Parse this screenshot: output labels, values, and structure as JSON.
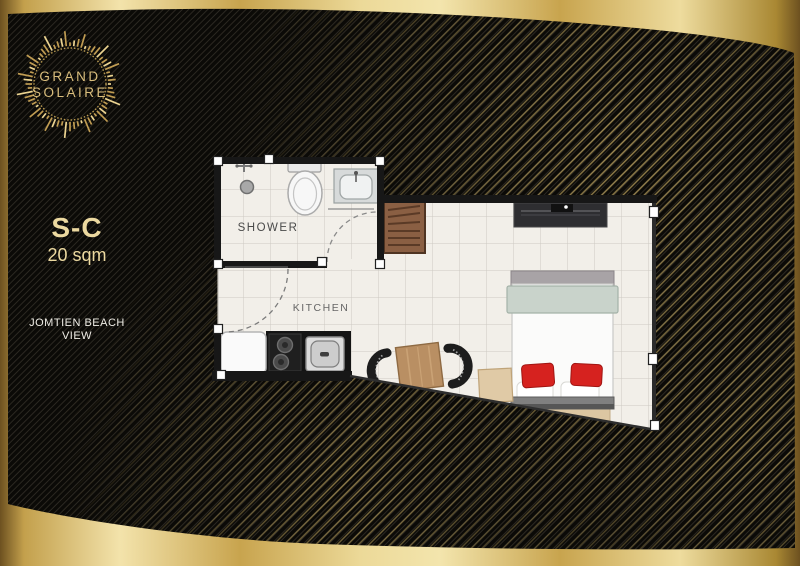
{
  "brand": {
    "name_line1": "GRAND",
    "name_line2": "SOLAIRE"
  },
  "unit": {
    "code": "S-C",
    "area": "20 sqm",
    "view": {
      "line1": "JOMTIEN BEACH",
      "line2": "VIEW"
    }
  },
  "floor_plan": {
    "room_labels": {
      "bathroom": "SHOWER",
      "kitchen": "KITCHEN"
    },
    "fixtures": [
      "shower-head",
      "toilet",
      "wash-basin",
      "bathroom-door-swing",
      "entrance-door-swing",
      "refrigerator",
      "two-burner-cooktop",
      "kitchen-sink",
      "wardrobe",
      "tv-console",
      "double-bed",
      "red-cushions",
      "bed-bench",
      "bedside-table",
      "dining-table",
      "dining-chairs",
      "window-wall"
    ]
  },
  "colors": {
    "gold_bright": "#f3e3ab",
    "gold_dark": "#6d5120",
    "panel_black": "#0b0a07",
    "floor": "#f2efe9",
    "wall": "#171717",
    "accent_red": "#d6221f",
    "text_gold": "#ecd9a0",
    "text_white": "#efede6",
    "bed_sage": "#c9d3cb",
    "wood": "#b98f63"
  }
}
